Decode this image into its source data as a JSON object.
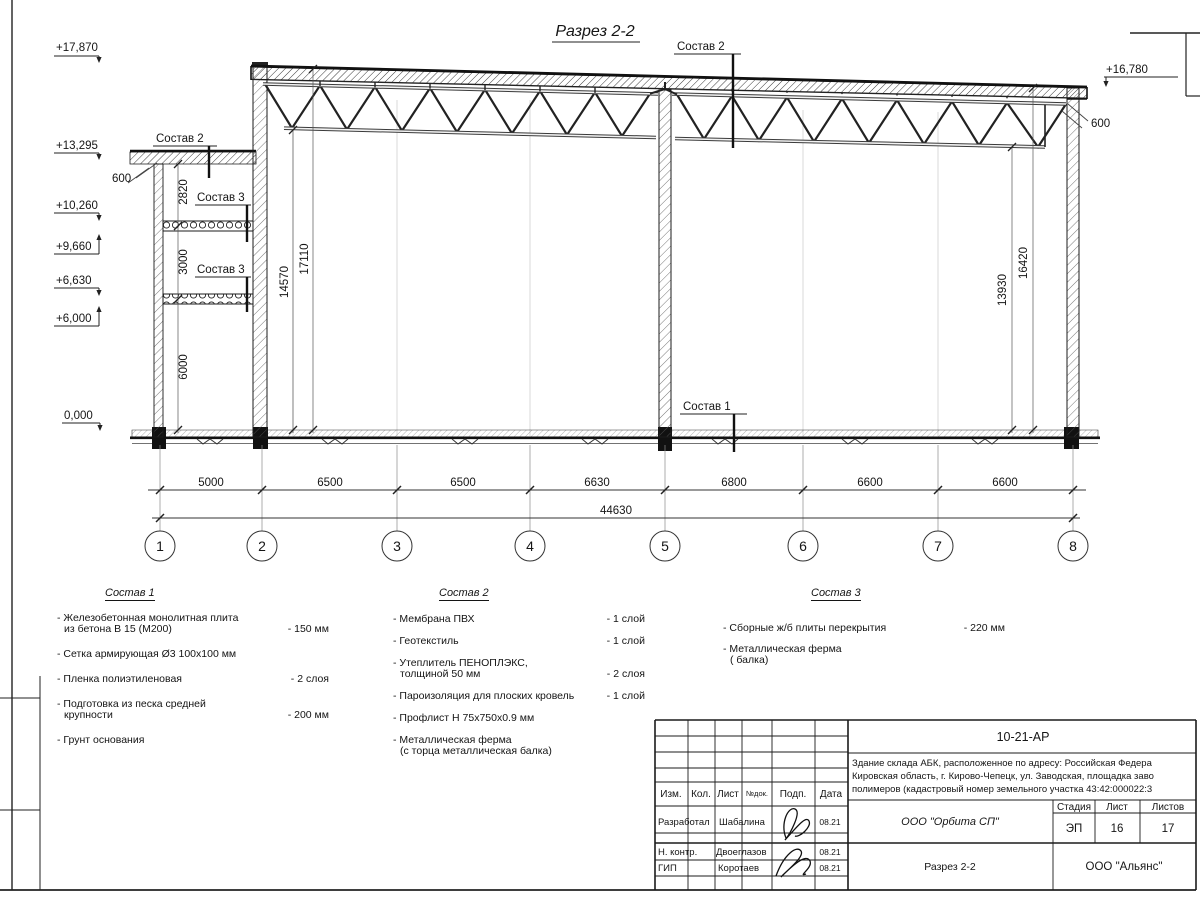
{
  "title": "Разрез 2-2",
  "labels": {
    "sostav1": "Состав 1",
    "sostav2": "Состав 2",
    "sostav3": "Состав 3"
  },
  "elevations": {
    "m17870": "+17,870",
    "m13295": "+13,295",
    "m10260": "+10,260",
    "m9660": "+9,660",
    "m6630": "+6,630",
    "m6000": "+6,000",
    "m0": "0,000",
    "m16780": "+16,780",
    "off600l": "600",
    "off600r": "600"
  },
  "vdims": {
    "d2820": "2820",
    "d3000": "3000",
    "d6000": "6000",
    "d14570": "14570",
    "d17110": "17110",
    "d13930": "13930",
    "d16420": "16420"
  },
  "hdims": {
    "s1": "5000",
    "s2": "6500",
    "s3": "6500",
    "s4": "6630",
    "s5": "6800",
    "s6": "6600",
    "s7": "6600",
    "total": "44630"
  },
  "axes": [
    "1",
    "2",
    "3",
    "4",
    "5",
    "6",
    "7",
    "8"
  ],
  "legend1": {
    "title": "Состав 1",
    "rows": [
      {
        "t": "- Железобетонная  монолитная плита",
        "v": ""
      },
      {
        "t": "из бетона В 15 (М200)",
        "v": "- 150 мм"
      },
      {
        "t": "- Сетка армирующая Ø3 100x100 мм",
        "v": ""
      },
      {
        "t": "- Пленка полиэтиленовая",
        "v": "-  2 слоя"
      },
      {
        "t": "- Подготовка из песка средней",
        "v": ""
      },
      {
        "t": "крупности",
        "v": "- 200 мм"
      },
      {
        "t": "- Грунт основания",
        "v": ""
      }
    ]
  },
  "legend2": {
    "title": "Состав 2",
    "rows": [
      {
        "t": "- Мембрана ПВХ",
        "v": "- 1 слой"
      },
      {
        "t": "- Геотекстиль",
        "v": "- 1 слой"
      },
      {
        "t": "- Утеплитель ПЕНОПЛЭКС,",
        "v": ""
      },
      {
        "t": "толщиной 50 мм",
        "v": "- 2 слоя"
      },
      {
        "t": "- Пароизоляция для плоских кровель",
        "v": "- 1 слой"
      },
      {
        "t": "- Профлист Н 75х750х0.9 мм",
        "v": ""
      },
      {
        "t": "- Металлическая ферма",
        "v": ""
      },
      {
        "t": "(с торца металлическая балка)",
        "v": ""
      }
    ]
  },
  "legend3": {
    "title": "Состав 3",
    "rows": [
      {
        "t": "- Сборные ж/б плиты перекрытия",
        "v": "- 220 мм"
      },
      {
        "t": "- Металлическая ферма",
        "v": ""
      },
      {
        "t": "( балка)",
        "v": ""
      }
    ]
  },
  "titleblock": {
    "doc_number": "10-21-АР",
    "project_line1": "Здание склада АБК, расположенное по адресу: Российская Федера",
    "project_line2": "Кировская область, г. Кирово-Чепецк, ул. Заводская, площадка заво",
    "project_line3": "полимеров (кадастровый номер земельного участка 43:42:000022:3",
    "cols": [
      "Изм.",
      "Кол.",
      "Лист",
      "№док.",
      "Подп.",
      "Дата"
    ],
    "role1": "Разработал",
    "role2": "Н. контр.",
    "role3": "ГИП",
    "name1": "Шабалина",
    "name2": "Двоеглазов",
    "name3": "Коротаев",
    "date1": "08.21",
    "date2": "08.21",
    "date3": "08.21",
    "org": "ООО \"Орбита СП\"",
    "sheet_title": "Разрез 2-2",
    "contractor": "ООО \"Альянс\"",
    "stage_label": "Стадия",
    "list_label": "Лист",
    "listov_label": "Листов",
    "stage": "ЭП",
    "list": "16",
    "listov": "17"
  }
}
